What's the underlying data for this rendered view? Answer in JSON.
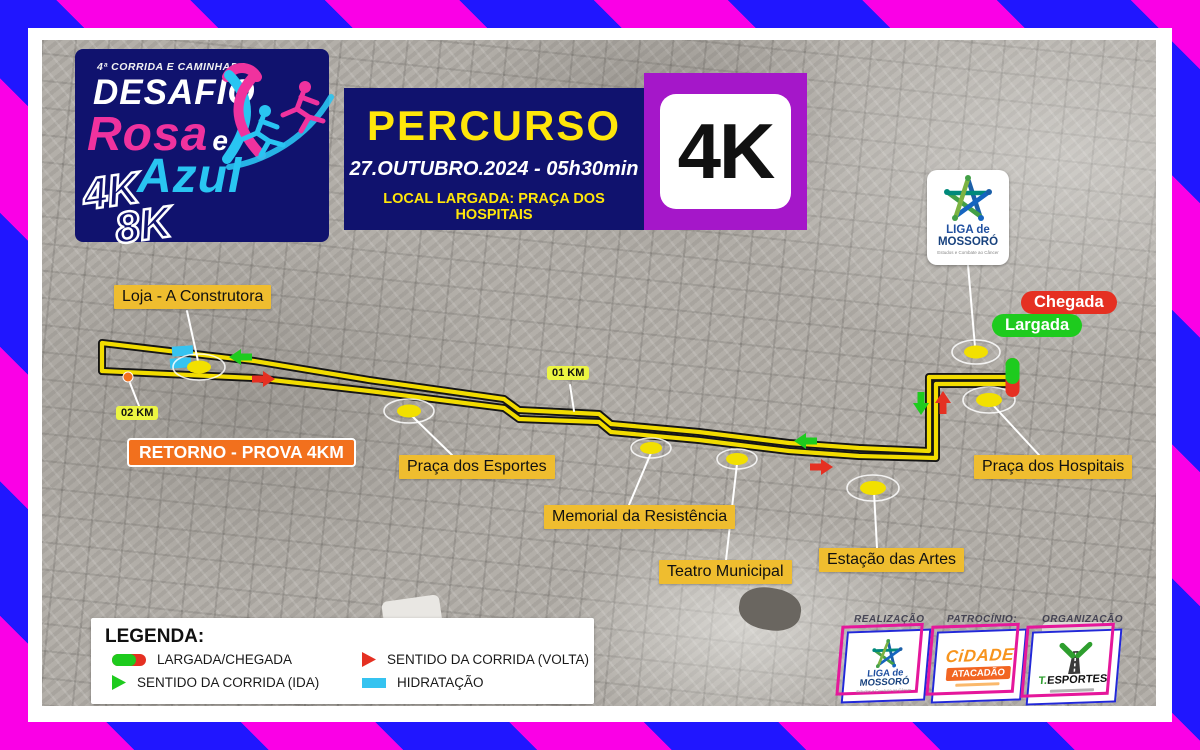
{
  "event": {
    "edition_line": "4ª CORRIDA E CAMINHADA",
    "title_word1": "DESAFIO",
    "title_rosa": "Rosa",
    "title_e": "e",
    "title_azul": "Azul",
    "distance_4k": "4K",
    "distance_8k": "8K"
  },
  "banner": {
    "title": "PERCURSO",
    "datetime": "27.OUTUBRO.2024   -   05h30min",
    "location": "LOCAL LARGADA: PRAÇA DOS HOSPITAIS"
  },
  "distance_badge": "4K",
  "liga_badge": {
    "name_line1": "LIGA de",
    "name_line2": "MOSSORÓ",
    "tagline": "Estudos e Combate ao Câncer"
  },
  "map_labels": {
    "loja": "Loja - A Construtora",
    "km01": "01 KM",
    "km02": "02 KM",
    "retorno": "RETORNO - PROVA 4KM",
    "esportes": "Praça dos Esportes",
    "memorial": "Memorial da Resistência",
    "teatro": "Teatro Municipal",
    "estacao": "Estação das Artes",
    "hospitais": "Praça dos Hospitais",
    "chegada": "Chegada",
    "largada": "Largada"
  },
  "legend": {
    "title": "LEGENDA:",
    "items": [
      {
        "icon": "start-finish-pill-icon",
        "label": "LARGADA/CHEGADA"
      },
      {
        "icon": "red-arrow-icon",
        "label": "SENTIDO DA CORRIDA (VOLTA)"
      },
      {
        "icon": "green-arrow-icon",
        "label": "SENTIDO DA CORRIDA (IDA)"
      },
      {
        "icon": "hydration-icon",
        "label": "HIDRATAÇÃO"
      }
    ]
  },
  "sponsors": {
    "realizacao_label": "REALIZAÇÃO",
    "patrocinio_label": "PATROCÍNIO:",
    "organizacao_label": "ORGANIZAÇÃO",
    "liga_line1": "LIGA de",
    "liga_line2": "MOSSORÓ",
    "liga_tagline": "Estudos e Combate ao Câncer",
    "cidade_line1": "CiDADE",
    "cidade_line2": "ATACADÃO",
    "esportes_name_dot": "T.",
    "esportes_name": "ESPORTES"
  },
  "colors": {
    "stripe_pink": "#fa00e6",
    "stripe_blue": "#2016ff",
    "navy": "#10126e",
    "purple": "#a517c9",
    "gold_label": "#efbd2f",
    "orange_retorno": "#f2701d",
    "route_yellow": "#f2dc00",
    "green": "#1ecb1e",
    "red": "#e53022",
    "cyan_hydration": "#35c3f0",
    "title_yellow": "#ffe60a",
    "rosa_pink": "#f0329e",
    "azul_cyan": "#29c5f2"
  }
}
